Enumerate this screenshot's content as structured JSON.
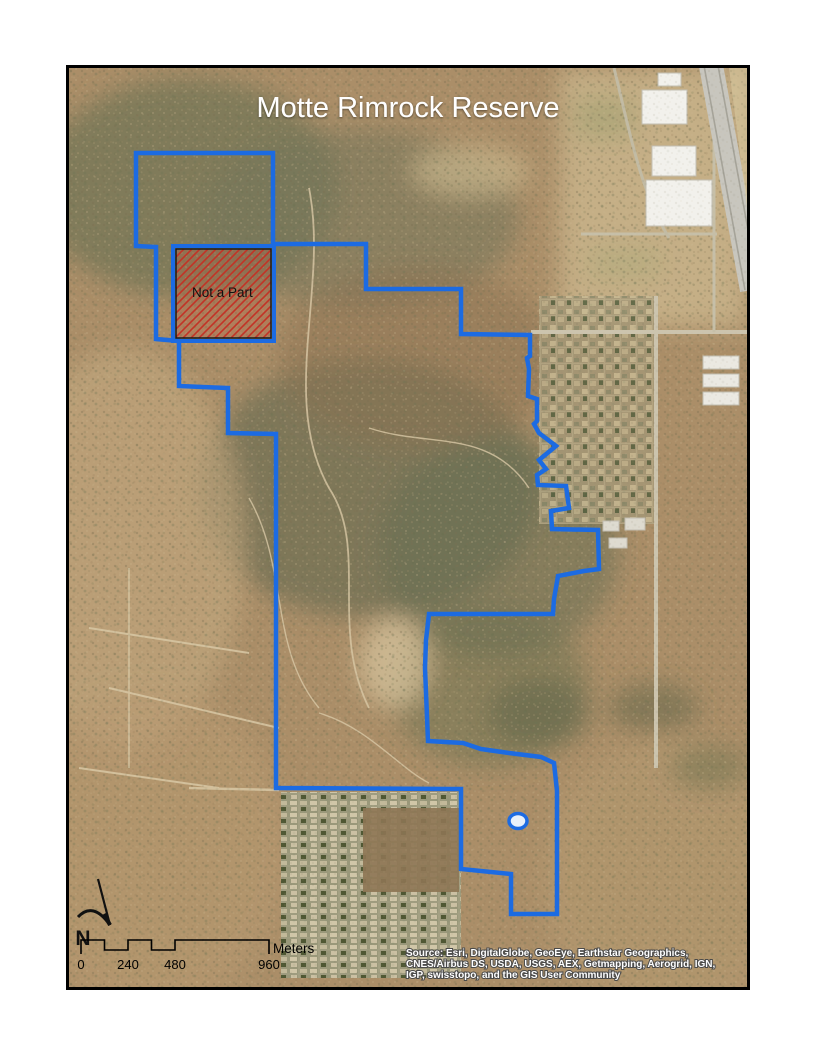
{
  "map": {
    "title": "Motte Rimrock Reserve",
    "boundary_color": "#1c6be2",
    "not_a_part": {
      "label": "Not a Part",
      "hatch_color": "#c23326"
    },
    "north_arrow": {
      "label": "N"
    },
    "scale_bar": {
      "ticks": [
        "0",
        "240",
        "480",
        "960"
      ],
      "unit_label": "Meters"
    },
    "attribution": {
      "line1": "Source: Esri, DigitalGlobe, GeoEye, Earthstar Geographics,",
      "line2": "CNES/Airbus DS, USDA, USGS, AEX, Getmapping, Aerogrid, IGN,",
      "line3": "IGP, swisstopo, and the GIS User Community"
    }
  }
}
